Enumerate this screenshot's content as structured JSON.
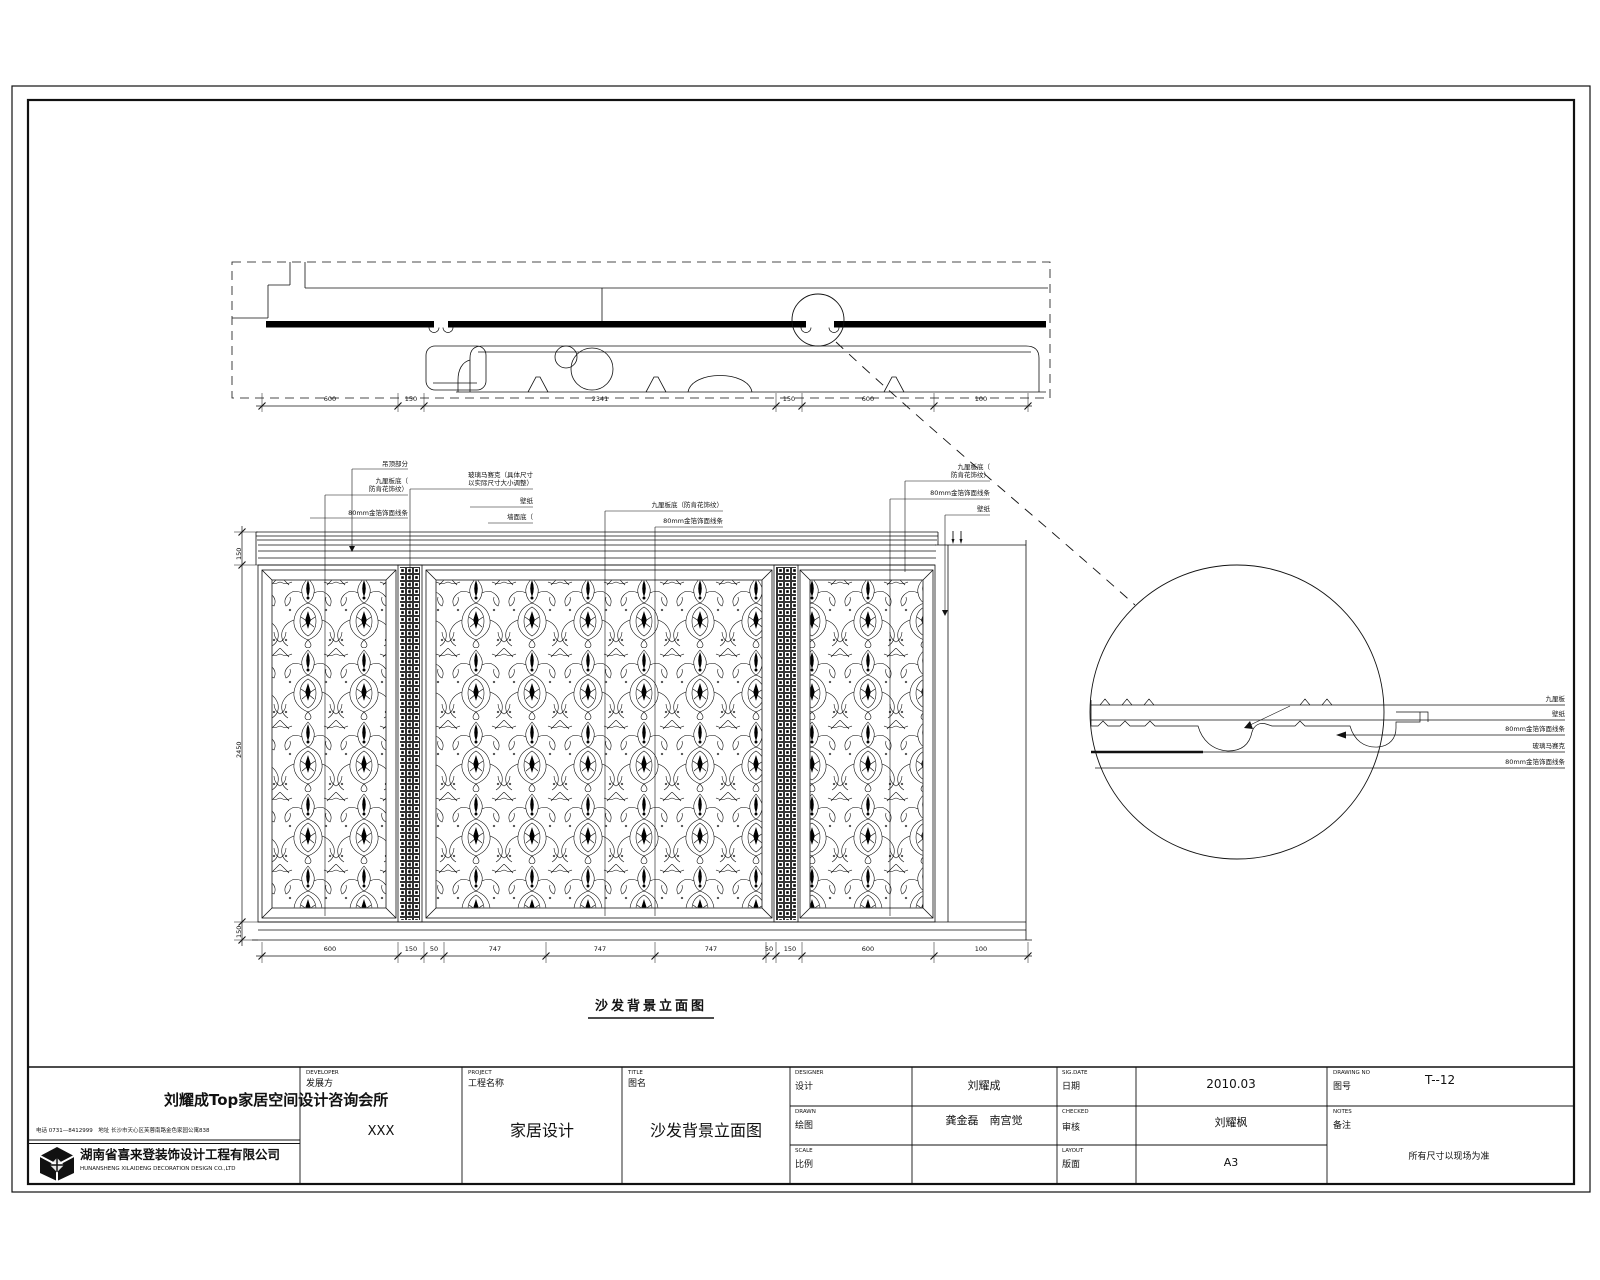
{
  "company": {
    "name": "刘耀成Top家居空间设计咨询会所",
    "contact": "电话 0731—8412999　地址 长沙市天心区芙蓉南路金色家园公寓838",
    "firm": "湖南省喜来登装饰设计工程有限公司",
    "firm_en": "HUNANSHENG XILAIDENG DECORATION DESIGN CO.,LTD"
  },
  "title_block": {
    "developer_en": "DEVELOPER",
    "developer": "发展方",
    "developer_value": "XXX",
    "project_en": "PROJECT",
    "project": "工程名称",
    "project_value": "家居设计",
    "title_en": "TITLE",
    "title": "图名",
    "title_value": "沙发背景立面图",
    "designer_en": "DESIGNER",
    "designer": "设计",
    "designer_value": "刘耀成",
    "drawn_en": "DRAWN",
    "drawn": "绘图",
    "drawn_value": "龚金磊　南宫觉",
    "scale_en": "SCALE",
    "scale": "比例",
    "scale_value": "",
    "date_en": "SIG.DATE",
    "date": "日期",
    "date_value": "2010.03",
    "checked_en": "CHECKED",
    "checked": "审核",
    "checked_value": "刘耀枫",
    "layout_en": "LAYOUT",
    "layout": "版面",
    "layout_value": "A3",
    "drawing_no_en": "DRAWING  NO",
    "drawing_no": "图号",
    "drawing_no_value": "T--12",
    "notes_en": "NOTES",
    "notes": "备注",
    "notes_value": "所有尺寸以现场为准"
  },
  "drawing": {
    "caption": "沙发背景立面图",
    "elev_labels": [
      "吊顶部分",
      "九厘板底（",
      "防肯花饰纹）",
      "80mm金箔饰面线条",
      "玻璃马赛克（具体尺寸",
      "以实际尺寸大小调整）",
      "壁纸",
      "墙面底（",
      "九厘板底（防肯花饰纹）",
      "80mm金箔饰面线条",
      "九厘板底（",
      "防肯花饰纹）",
      "80mm金箔饰面线条",
      "壁纸"
    ],
    "detail_labels": [
      "九厘板",
      "壁纸",
      "80mm金箔饰面线条",
      "玻璃马赛克",
      "80mm金箔饰面线条"
    ],
    "plan_dims": [
      "600",
      "150",
      "2341",
      "150",
      "600",
      "100"
    ],
    "elev_bottom_dims": [
      "600",
      "150",
      "50",
      "747",
      "747",
      "747",
      "50",
      "150",
      "600",
      "100"
    ],
    "elev_left_dims": [
      "150",
      "2450",
      "150"
    ]
  }
}
